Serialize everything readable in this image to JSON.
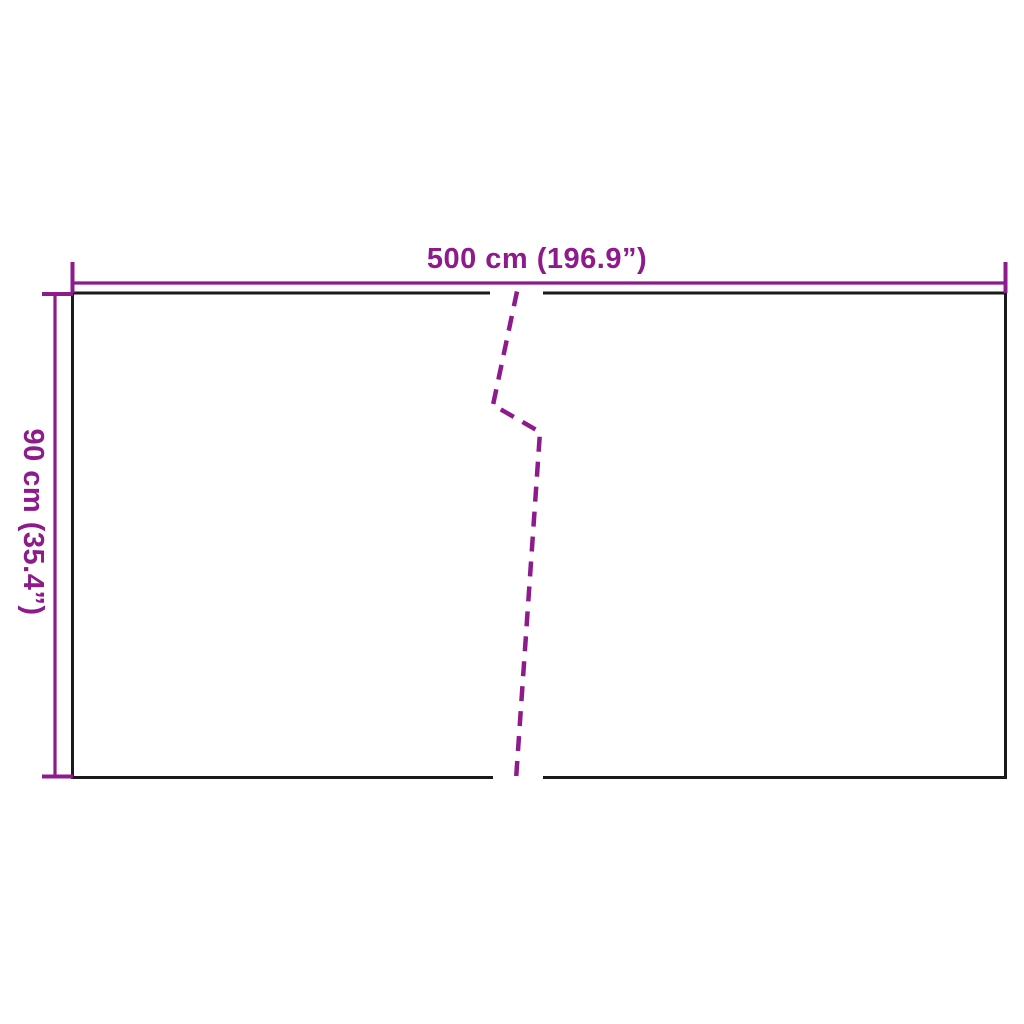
{
  "diagram": {
    "type": "product-dimension-drawing",
    "width_label": "500 cm (196.9”)",
    "height_label": "90 cm (35.4”)"
  },
  "colors": {
    "dimension": "#8E1B8C",
    "outline": "#1A1A1A",
    "background": "#FFFFFF"
  }
}
